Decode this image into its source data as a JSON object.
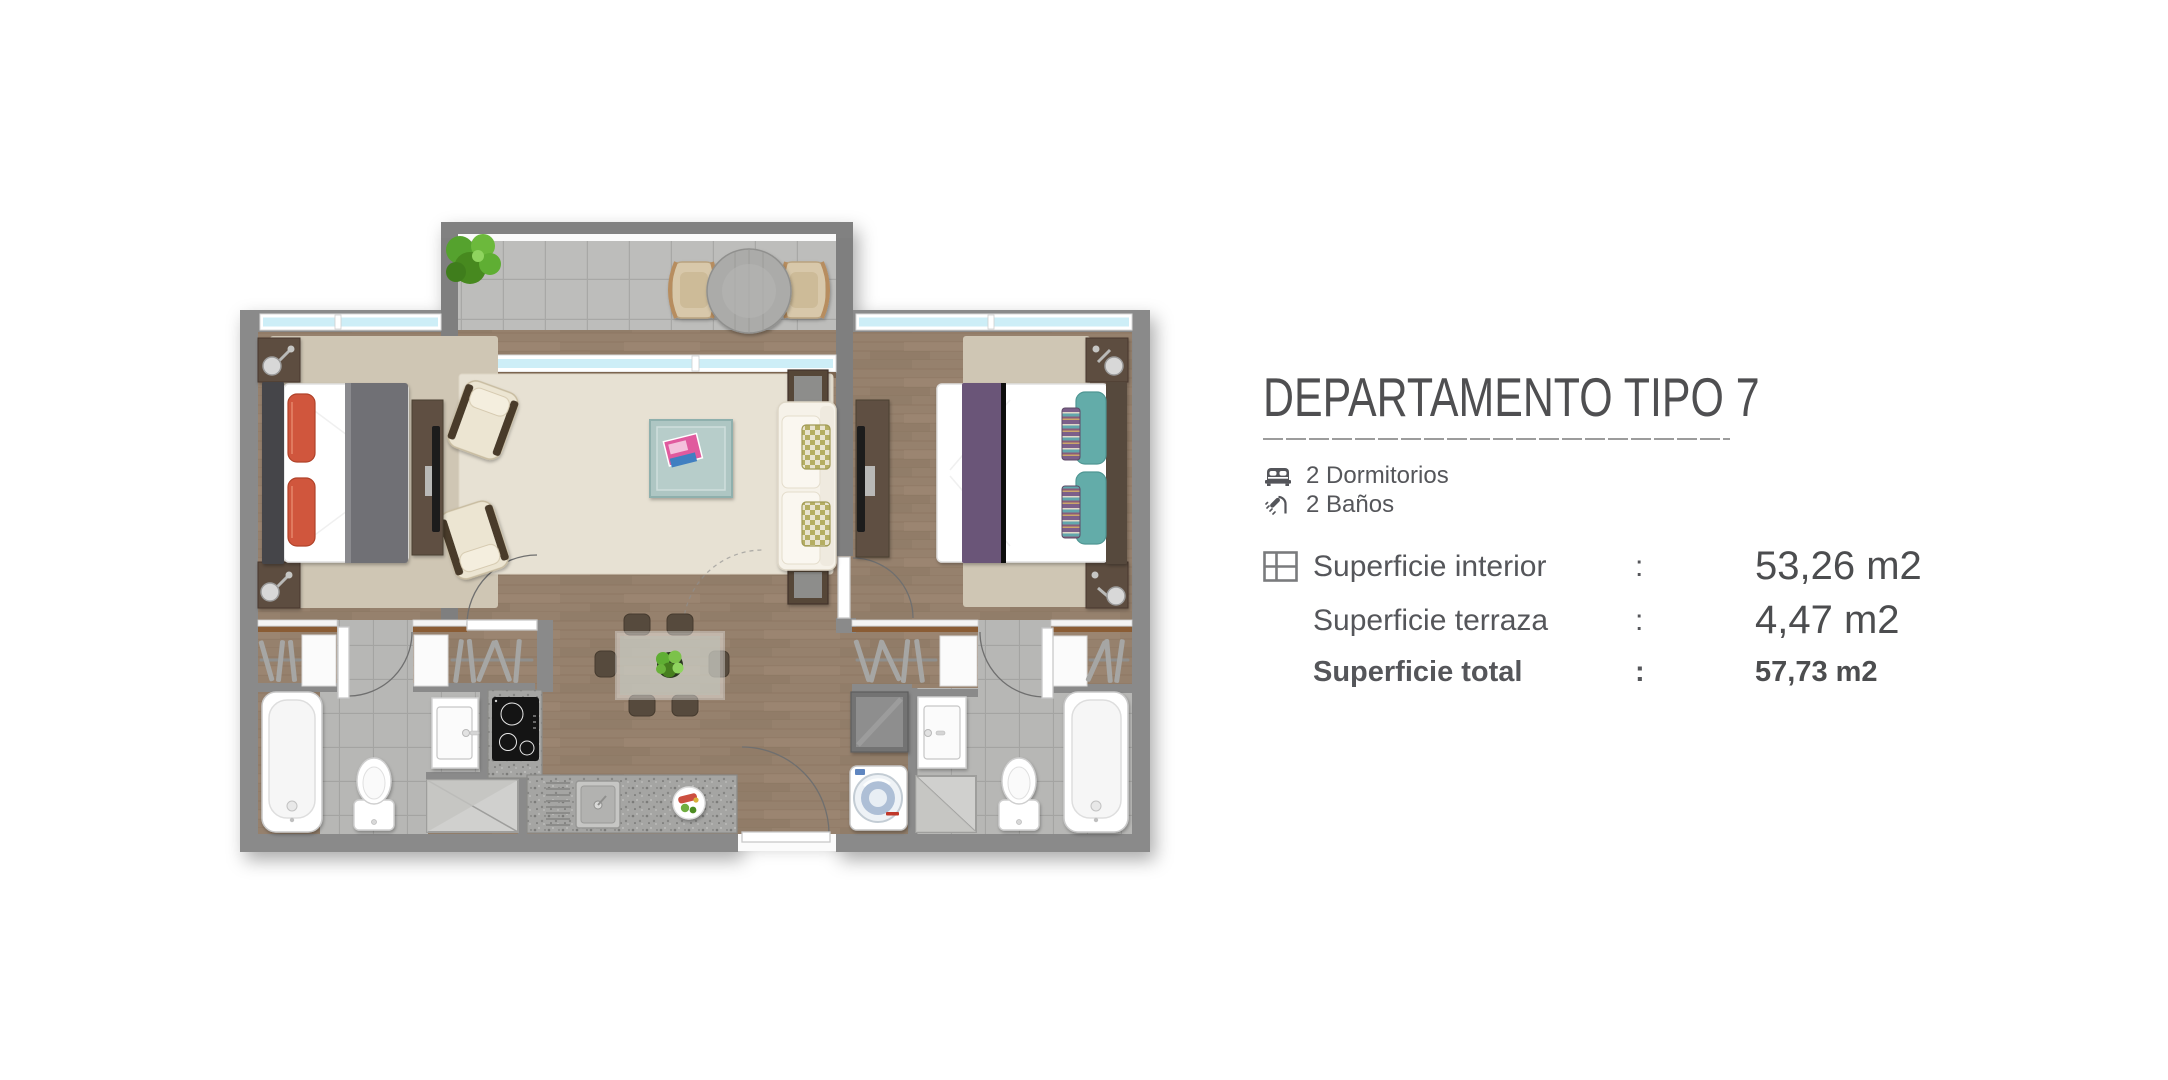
{
  "header": {
    "title": "DEPARTAMENTO TIPO 7"
  },
  "features": [
    {
      "icon": "bed-icon",
      "label": "2 Dormitorios"
    },
    {
      "icon": "shower-icon",
      "label": "2 Baños"
    }
  ],
  "areas": {
    "rows": [
      {
        "icon": "floorplan-grid-icon",
        "label": "Superficie interior",
        "separator": ":",
        "value": "53,26 m2",
        "bold": false
      },
      {
        "icon": "",
        "label": "Superficie terraza",
        "separator": ":",
        "value": "4,47 m2",
        "bold": false
      },
      {
        "icon": "",
        "label": "Superficie total",
        "separator": ":",
        "value": "57,73 m2",
        "bold": true
      }
    ]
  },
  "palette": {
    "title-color": "#4f4f51",
    "text-color": "#55565a",
    "line-color": "#9c9c9c",
    "wall-gray": "#8a8a8a",
    "wood-floor": "#96816d",
    "terrace-tile": "#bcbcba",
    "bath-tile": "#b7b7b5",
    "rug-beige": "#cfc6b4",
    "rug-living": "#e7e1d3",
    "window-glass": "#cdeef7",
    "bed1-pillow-orange": "#d0573c",
    "bed1-blanket-gray": "#707074",
    "bed2-runner-purple": "#6a5478",
    "bed2-pillow-teal": "#63aca9",
    "coffee-table-teal": "#aec6c3",
    "plant-green": "#5aa433",
    "granite": "#a5a5a3"
  }
}
